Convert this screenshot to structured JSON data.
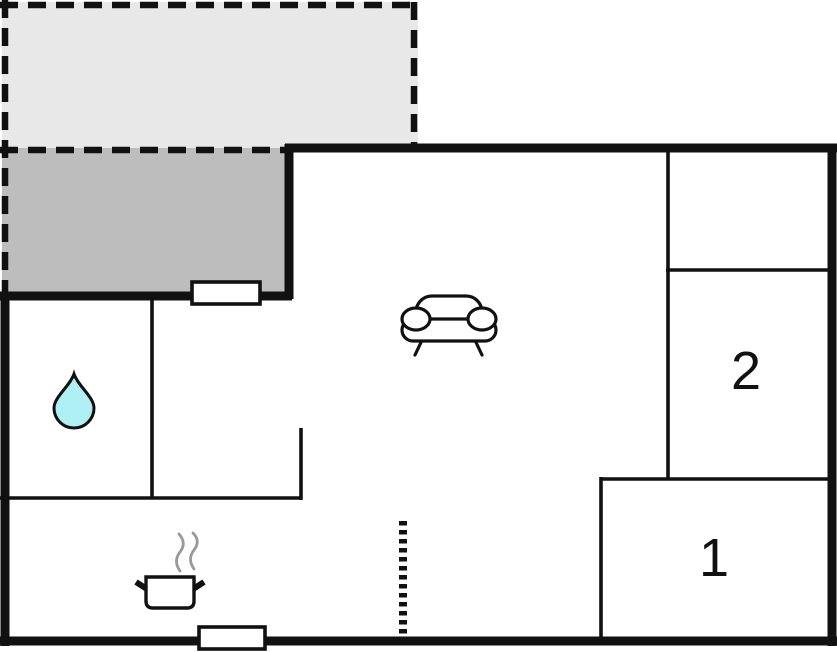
{
  "plan": {
    "room_labels": {
      "room_1": "1",
      "room_2": "2"
    }
  },
  "icons": {
    "sofa": "sofa-icon",
    "water_drop": "water-drop-icon",
    "cooking_pot": "cooking-pot-icon",
    "steam": "steam-icon"
  },
  "colors": {
    "wall": "#111111",
    "terrace_fill": "#e8e8e8",
    "patio_fill": "#bdbdbd",
    "water_drop_fill": "#aeeff4",
    "steam": "#999999",
    "window_fill": "#ffffff",
    "background": "#ffffff"
  }
}
